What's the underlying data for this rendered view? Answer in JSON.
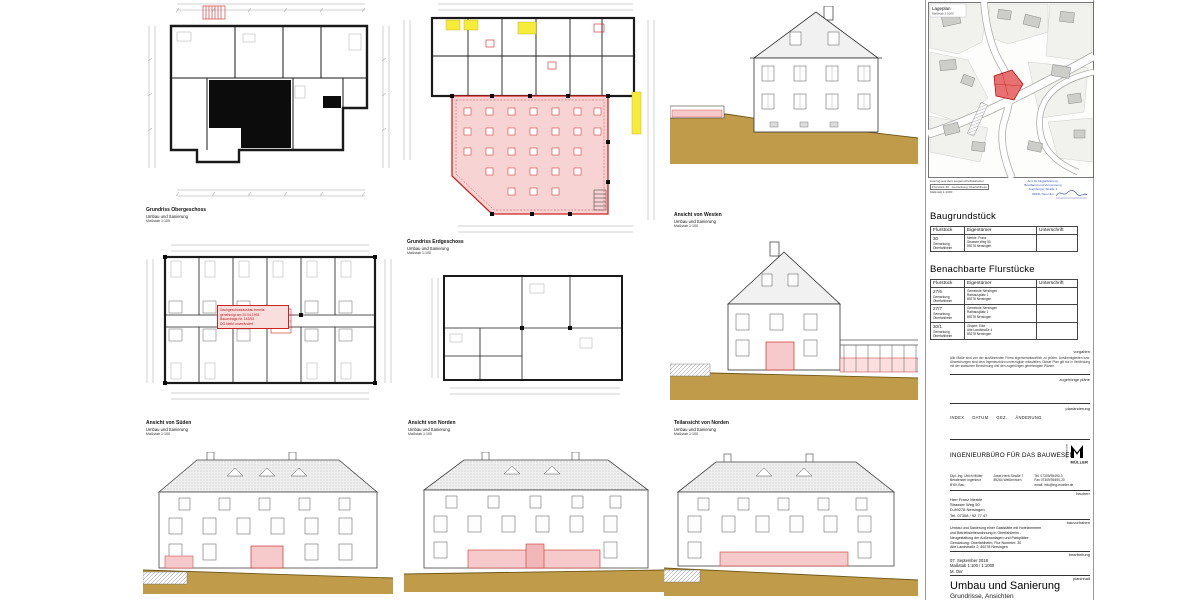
{
  "colors": {
    "highlight_red": "#cc2222",
    "highlight_pink": "#f6caca",
    "highlight_yellow": "#f7ec3a",
    "ground_tan": "#bf9b4a",
    "map_building_red": "#e77070",
    "stamp_blue": "#3a56b4"
  },
  "captions": {
    "og": {
      "title": "Grundriss Obergeschoss",
      "sub": "Umbau und Sanierung",
      "scale": "Maßstab 1:100"
    },
    "eg": {
      "title": "Grundriss Erdgeschoss",
      "sub": "Umbau und Sanierung",
      "scale": "Maßstab 1:100"
    },
    "westen": {
      "title": "Ansicht von Westen",
      "sub": "Umbau und Sanierung",
      "scale": "Maßstab 1:100"
    },
    "sueden": {
      "title": "Ansicht von Süden",
      "sub": "Umbau und Sanierung",
      "scale": "Maßstab 1:100"
    },
    "norden": {
      "title": "Ansicht von Norden",
      "sub": "Umbau und Sanierung",
      "scale": "Maßstab 1:100"
    },
    "teil": {
      "title": "Teilansicht von Norden",
      "sub": "Umbau und Sanierung",
      "scale": "Maßstab 1:100"
    }
  },
  "plan_note": {
    "lines": [
      "Dachgeschossausbau bereits",
      "genehmigt am 20.04.1993",
      "Bauantrags-Nr. 143/93",
      "DG bleibt unverändert"
    ]
  },
  "map": {
    "title": "Lageplan",
    "scale": "Maßstab 1:1000",
    "footnotes": [
      "Auszug aus dem Liegenschaftskataster",
      "Flurstück 30 · Gemarkung Oberfahlheim",
      "Maßstab 1:1000"
    ],
    "stamp_lines": [
      "Amt für Digitalisierung,",
      "Breitband und Vermessung",
      "Augsburger Straße 1",
      "89231 Neu-Ulm"
    ]
  },
  "baugrundstueck": {
    "heading": "Baugrundstück",
    "headers": [
      "Flurstück",
      "Eigentümer",
      "Unterschrift"
    ],
    "rows": [
      {
        "flurstueck": [
          "30",
          "Gemarkung",
          "Oberfahlheim"
        ],
        "eigentuemer": [
          "Merkle, Franz",
          "Strasser Weg 50",
          "89278 Nersingen"
        ],
        "unterschrift": ""
      }
    ]
  },
  "benachbarte": {
    "heading": "Benachbarte Flurstücke",
    "headers": [
      "Flurstück",
      "Eigentümer",
      "Unterschrift"
    ],
    "rows": [
      {
        "flurstueck": [
          "27/6",
          "Gemarkung",
          "Oberfahlheim"
        ],
        "eigentuemer": [
          "Gemeinde Nersingen",
          "Rathausplatz 1",
          "89278 Nersingen"
        ],
        "unterschrift": ""
      },
      {
        "flurstueck": [
          "27/7",
          "Gemarkung",
          "Oberfahlheim"
        ],
        "eigentuemer": [
          "Gemeinde Nersingen",
          "Rathausplatz 1",
          "89278 Nersingen"
        ],
        "unterschrift": ""
      },
      {
        "flurstueck": [
          "30/1",
          "Gemarkung",
          "Oberfahlheim"
        ],
        "eigentuemer": [
          "Gispert, Elke",
          "Alte Landstraße 4",
          "89278 Nersingen"
        ],
        "unterschrift": ""
      }
    ]
  },
  "titleblock": {
    "labels": {
      "vorgaben": "vorgaben",
      "plaene": "zugehörige pläne",
      "planaenderung": "planänderung",
      "bauherr": "bauherr",
      "bauvorhaben": "bauvorhaben",
      "bearbeitung": "bearbeitung",
      "planinhalt": "planinhalt"
    },
    "vorgaben_text": "Alle Maße sind von der ausführenden Firma eigenverantwortlich zu prüfen. Unstimmigkeiten bzw. Abweichungen sind dem Ingenieurbüro unverzüglich mitzuteilen. Dieser Plan gilt nur in Verbindung mit der statischen Berechnung und den zugehörigen genehmigten Plänen.",
    "index_cols": [
      "INDEX",
      "DATUM",
      "GEZ.",
      "ÄNDERUNG"
    ],
    "firm": {
      "name": "INGENIEURBÜRO FÜR DAS BAUWESEN",
      "logo": "MÜLLER",
      "logo_vertical": "INGENIEURBÜRO",
      "col1": [
        "Dipl.-Ing. Ulrich Müller",
        "Beratender Ingenieur",
        "BYIK Bau"
      ],
      "col2": [
        "Josef-Herb-Straße 7",
        "89264 Weißenhorn"
      ],
      "col3": [
        "Tel. 07309/95490-0",
        "Fax 07309/95490-20",
        "email: info@ing-mueller.de"
      ]
    },
    "bauherr_block": [
      "Herr Franz Merkle",
      "Strasser Weg 50",
      "D-89278 Nersingen",
      "Tel. 07308 / 92 77 47"
    ],
    "bauvorhaben_text": [
      "Umbau und Sanierung einer Gaststätte mit Hotelzimmern",
      "und Betriebsleiterwohnung in Oberfahlheim -",
      "Neugestaltung der Außenanlagen und Parkplätze",
      "Gemarkung: Oberfahlheim; Flur Nummer: 30",
      "Alte Landstraße 2; 89278 Nersingen"
    ],
    "bearbeitung_block": [
      "07. September 2018",
      "Maßstab 1:100 / 1:1000",
      "M. Oer"
    ],
    "planinhalt": {
      "title": "Umbau und Sanierung",
      "subtitle": "Grundrisse, Ansichten"
    }
  }
}
